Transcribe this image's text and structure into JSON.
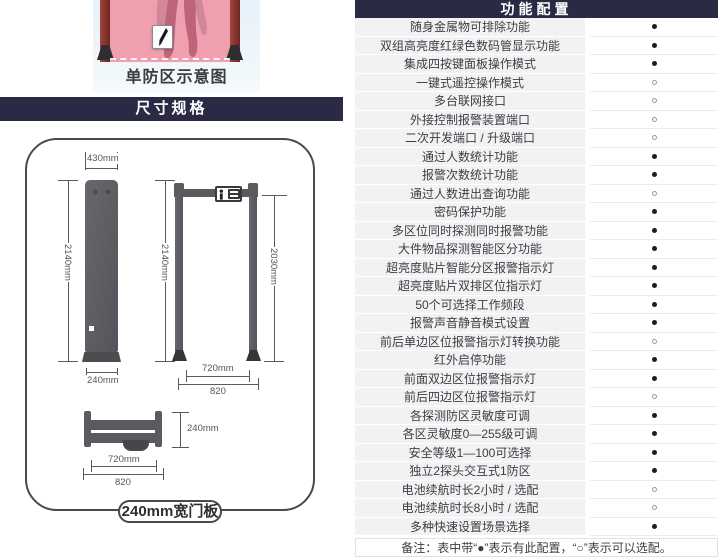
{
  "photo": {
    "caption": "单防区示意图"
  },
  "size_banner": "尺寸规格",
  "dims": {
    "side": {
      "top": "430mm",
      "height": "2140mm",
      "bottom": "240mm"
    },
    "front": {
      "height_outer": "2140mm",
      "height_inner": "2030mm",
      "width_inner": "720mm",
      "width_outer": "820"
    },
    "top": {
      "depth": "240mm",
      "width_inner": "720mm",
      "width_outer": "820"
    }
  },
  "panel_label": "240mm宽门板",
  "table": {
    "title": "功能配置",
    "rows": [
      {
        "label": "随身金属物可排除功能",
        "value": "filled"
      },
      {
        "label": "双组高亮度红绿色数码管显示功能",
        "value": "filled"
      },
      {
        "label": "集成四按键面板操作模式",
        "value": "filled"
      },
      {
        "label": "一键式遥控操作模式",
        "value": "hollow"
      },
      {
        "label": "多台联网接口",
        "value": "hollow"
      },
      {
        "label": "外接控制报警装置端口",
        "value": "hollow"
      },
      {
        "label": "二次开发端口 / 升级端口",
        "value": "hollow"
      },
      {
        "label": "通过人数统计功能",
        "value": "filled"
      },
      {
        "label": "报警次数统计功能",
        "value": "filled"
      },
      {
        "label": "通过人数进出查询功能",
        "value": "hollow"
      },
      {
        "label": "密码保护功能",
        "value": "filled"
      },
      {
        "label": "多区位同时探测同时报警功能",
        "value": "filled"
      },
      {
        "label": "大件物品探测智能区分功能",
        "value": "filled"
      },
      {
        "label": "超亮度贴片智能分区报警指示灯",
        "value": "filled"
      },
      {
        "label": "超亮度贴片双排区位指示灯",
        "value": "filled"
      },
      {
        "label": "50个可选择工作频段",
        "value": "filled"
      },
      {
        "label": "报警声音静音模式设置",
        "value": "filled"
      },
      {
        "label": "前后单边区位报警指示灯转换功能",
        "value": "hollow"
      },
      {
        "label": "红外启停功能",
        "value": "filled"
      },
      {
        "label": "前面双边区位报警指示灯",
        "value": "filled"
      },
      {
        "label": "前后四边区位报警指示灯",
        "value": "hollow"
      },
      {
        "label": "各探测防区灵敏度可调",
        "value": "filled"
      },
      {
        "label": "各区灵敏度0—255级可调",
        "value": "filled"
      },
      {
        "label": "安全等级1—100可选择",
        "value": "filled"
      },
      {
        "label": "独立2探头交互式1防区",
        "value": "filled"
      },
      {
        "label": "电池续航时长2小时 / 选配",
        "value": "hollow"
      },
      {
        "label": "电池续航时长8小时 / 选配",
        "value": "hollow"
      },
      {
        "label": "多种快速设置场景选择",
        "value": "filled"
      }
    ],
    "note": "备注：表中带“●”表示有此配置，“○”表示可以选配。"
  },
  "colors": {
    "navy": "#2a2a45",
    "row_bg": "#f2f2f4",
    "pink": "#ef9fae",
    "post_maroon": "#8c352f",
    "diagram_gray": "#5a5a5f"
  }
}
